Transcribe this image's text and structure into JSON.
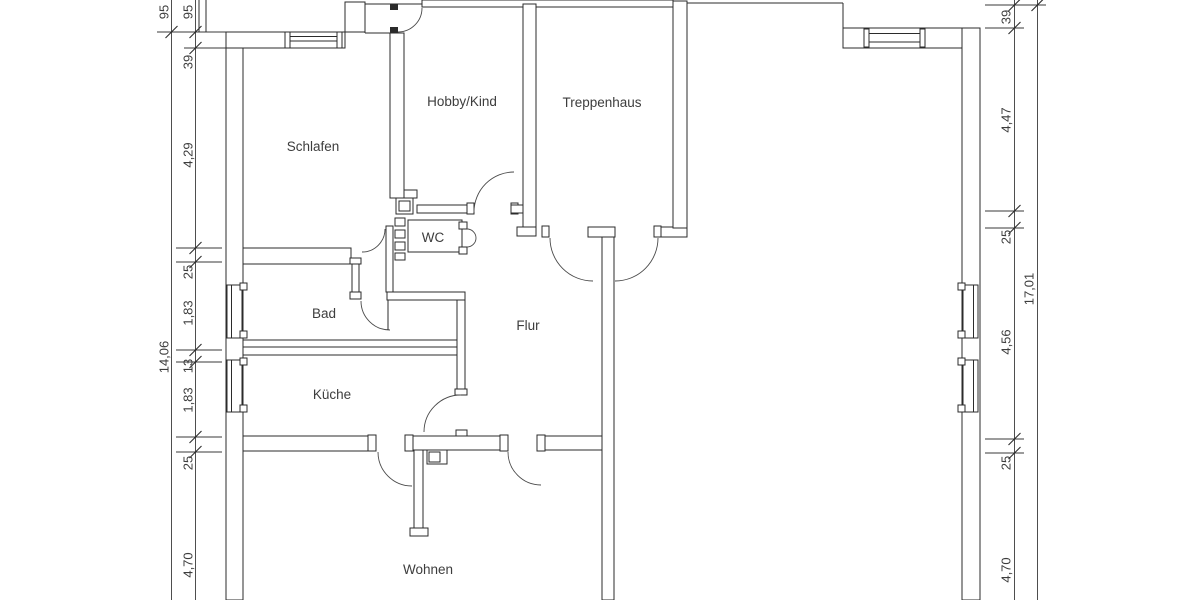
{
  "drawing": {
    "kind": "floor-plan",
    "language": "de"
  },
  "rooms": {
    "schlafen": "Schlafen",
    "hobby": "Hobby/Kind",
    "treppenhaus": "Treppenhaus",
    "wc": "WC",
    "bad": "Bad",
    "flur": "Flur",
    "kueche": "Küche",
    "wohnen": "Wohnen"
  },
  "dims": {
    "left_outer": [
      "95",
      "14,06"
    ],
    "left_inner": [
      "95",
      "39",
      "4,29",
      "25",
      "1,83",
      "13",
      "1,83",
      "25",
      "4,70"
    ],
    "right_inner": [
      "39",
      "4,47",
      "25",
      "4,56",
      "25",
      "4,70"
    ],
    "right_outer": [
      "17,01"
    ]
  }
}
